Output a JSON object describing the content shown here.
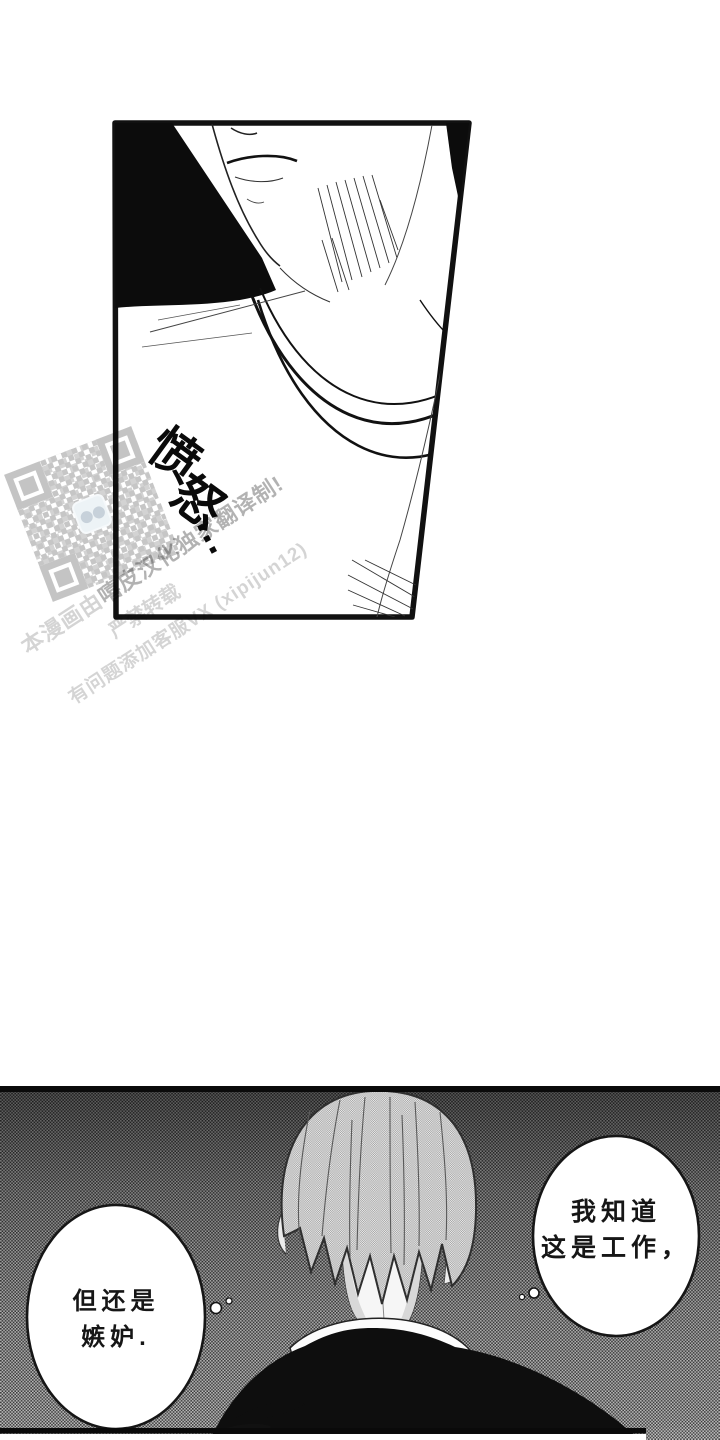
{
  "page": {
    "type": "manga-webtoon-page",
    "background_color": "#ffffff",
    "ink_color": "#111111"
  },
  "panel_top": {
    "description": "close-up of a man's chin, lips and collarbone with necklace, heavy black shadow",
    "sfx_chars": [
      "愤",
      "怒",
      "…"
    ]
  },
  "watermark": {
    "line1_light": "本漫画由",
    "line1_bold": "嘻皮汉化独家翻译制!",
    "line2": "严禁转载",
    "line3": "有问题添加客服VX (xipijun12)",
    "qr_icon": "qr-code"
  },
  "panel_bottom": {
    "description": "back view of a man with light hair on dark halftone background",
    "thought_bubble_right": {
      "line1": "我知道",
      "line2": "这是工作，"
    },
    "thought_bubble_left": {
      "line1": "但还是",
      "line2": "嫉妒."
    }
  },
  "colors": {
    "halftone_dark": "#3f3f3f",
    "halftone_light": "#c7c7c7",
    "hair_tone": "#c4c4c4",
    "qr_tint": "#dbe7ee"
  }
}
